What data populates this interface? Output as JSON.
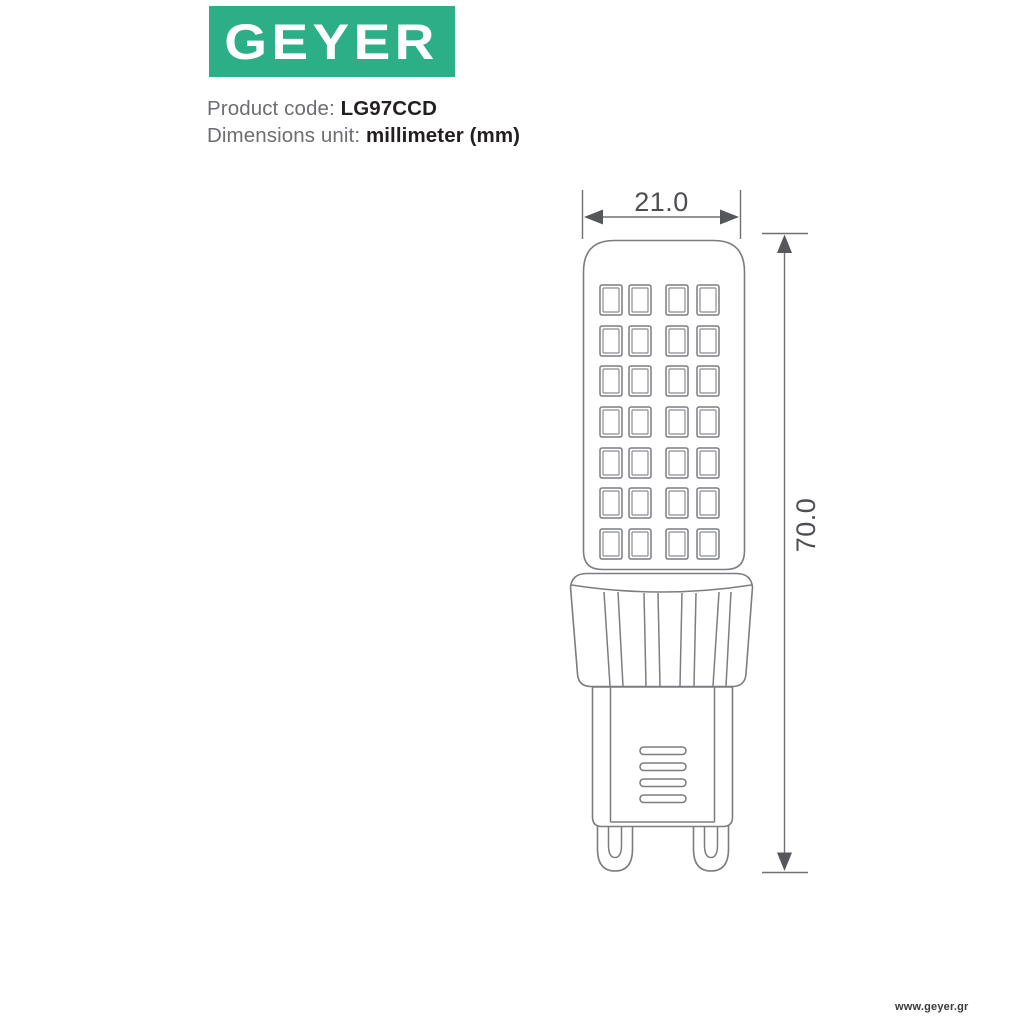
{
  "header": {
    "logo_text": "GEYER",
    "logo_bg_color": "#2CAE87",
    "product_code_label": "Product code: ",
    "product_code_value": "LG97CCD",
    "dimensions_unit_label": "Dimensions unit: ",
    "dimensions_unit_value": "millimeter (mm)"
  },
  "diagram": {
    "type": "technical-drawing",
    "subject": "G9 LED capsule lamp, front elevation",
    "width_dimension": {
      "label": "21.0",
      "unit": "mm"
    },
    "height_dimension": {
      "label": "70.0",
      "unit": "mm"
    },
    "led_grid": {
      "rows": 7,
      "columns": 4
    },
    "collar_ribs": 4,
    "vent_slots": 4,
    "pins": 2,
    "line_color": "#7b7d80",
    "dimension_color": "#55575a",
    "text_color": "#4c4e52"
  },
  "footer": {
    "website": "www.geyer.gr"
  }
}
